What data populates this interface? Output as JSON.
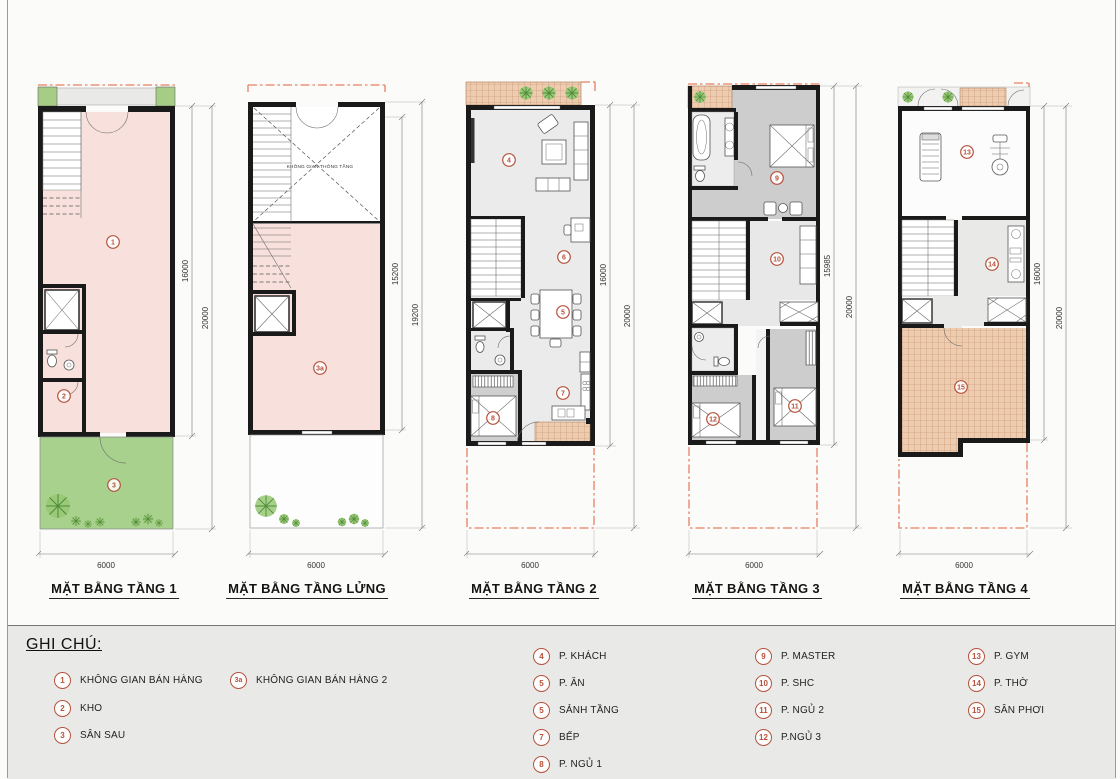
{
  "plans": [
    {
      "title": "MẶT BẰNG TẦNG 1",
      "dims": {
        "inner": "16000",
        "outer": "20000",
        "width": "6000"
      },
      "rooms": [
        "1",
        "2",
        "3"
      ]
    },
    {
      "title": "MẶT BẰNG TẦNG LỬNG",
      "dims": {
        "inner": "15200",
        "outer": "19200",
        "width": "6000"
      },
      "rooms": [
        "3a"
      ],
      "void_label": "KHÔNG GIAN THÔNG TẦNG"
    },
    {
      "title": "MẶT BẰNG TẦNG 2",
      "dims": {
        "inner": "16000",
        "outer": "20000",
        "width": "6000"
      },
      "rooms": [
        "4",
        "6",
        "5",
        "7",
        "8"
      ]
    },
    {
      "title": "MẶT BẰNG TẦNG 3",
      "dims": {
        "inner": "15985",
        "outer": "20000",
        "width": "6000"
      },
      "rooms": [
        "9",
        "10",
        "11",
        "12"
      ]
    },
    {
      "title": "MẶT BẰNG TẦNG 4",
      "dims": {
        "inner": "16000",
        "outer": "20000",
        "width": "6000"
      },
      "rooms": [
        "13",
        "14",
        "15"
      ]
    }
  ],
  "legend": {
    "title": "GHI CHÚ:",
    "columns": [
      {
        "items": [
          {
            "num": "1",
            "label": "KHÔNG GIAN BÁN HÀNG"
          },
          {
            "num": "2",
            "label": "KHO"
          },
          {
            "num": "3",
            "label": "SÂN SAU"
          }
        ]
      },
      {
        "items": [
          {
            "num": "3a",
            "label": "KHÔNG GIAN BÁN HÀNG 2"
          }
        ]
      },
      {
        "items": [
          {
            "num": "4",
            "label": "P. KHÁCH"
          },
          {
            "num": "5",
            "label": "P. ĂN"
          },
          {
            "num": "5",
            "label": "SẢNH TẦNG"
          },
          {
            "num": "7",
            "label": "BẾP"
          },
          {
            "num": "8",
            "label": "P. NGỦ 1"
          }
        ]
      },
      {
        "items": [
          {
            "num": "9",
            "label": "P. MASTER"
          },
          {
            "num": "10",
            "label": "P. SHC"
          },
          {
            "num": "11",
            "label": "P. NGỦ 2"
          },
          {
            "num": "12",
            "label": "P.NGỦ 3"
          }
        ]
      },
      {
        "items": [
          {
            "num": "13",
            "label": "P. GYM"
          },
          {
            "num": "14",
            "label": "P. THỜ"
          },
          {
            "num": "15",
            "label": "SÂN PHƠI"
          }
        ]
      }
    ]
  },
  "colors": {
    "accent": "#b6523c",
    "dash": "#e87f60",
    "pink": "#f8e1dc",
    "garden": "#a9d18e",
    "tile": "#edccb0",
    "wall": "#1a1a1a"
  }
}
